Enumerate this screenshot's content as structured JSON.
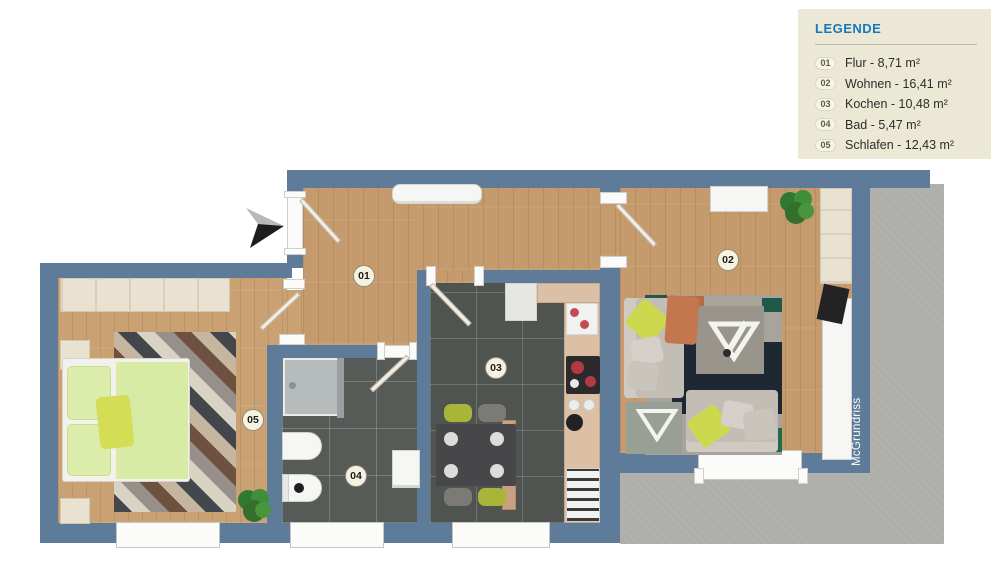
{
  "legend": {
    "title": "LEGENDE",
    "items": [
      {
        "num": "01",
        "label": "Flur - 8,71 m²"
      },
      {
        "num": "02",
        "label": "Wohnen - 16,41 m²"
      },
      {
        "num": "03",
        "label": "Kochen - 10,48 m²"
      },
      {
        "num": "04",
        "label": "Bad - 5,47 m²"
      },
      {
        "num": "05",
        "label": "Schlafen - 12,43 m²"
      }
    ],
    "colors": {
      "background": "#ece8d6",
      "title": "#1878be",
      "number": "#55604b"
    }
  },
  "plan": {
    "watermark": "McGrundriss",
    "room_badges": [
      "01",
      "02",
      "03",
      "04",
      "05"
    ],
    "colors": {
      "wall": "#5e7c99",
      "wood_floor": "#c59a6d",
      "kitchen_tile": "#4f5450",
      "bath_tile": "#565b58",
      "terrace": "#aeaeab",
      "accent_green": "#ccd84e"
    }
  }
}
